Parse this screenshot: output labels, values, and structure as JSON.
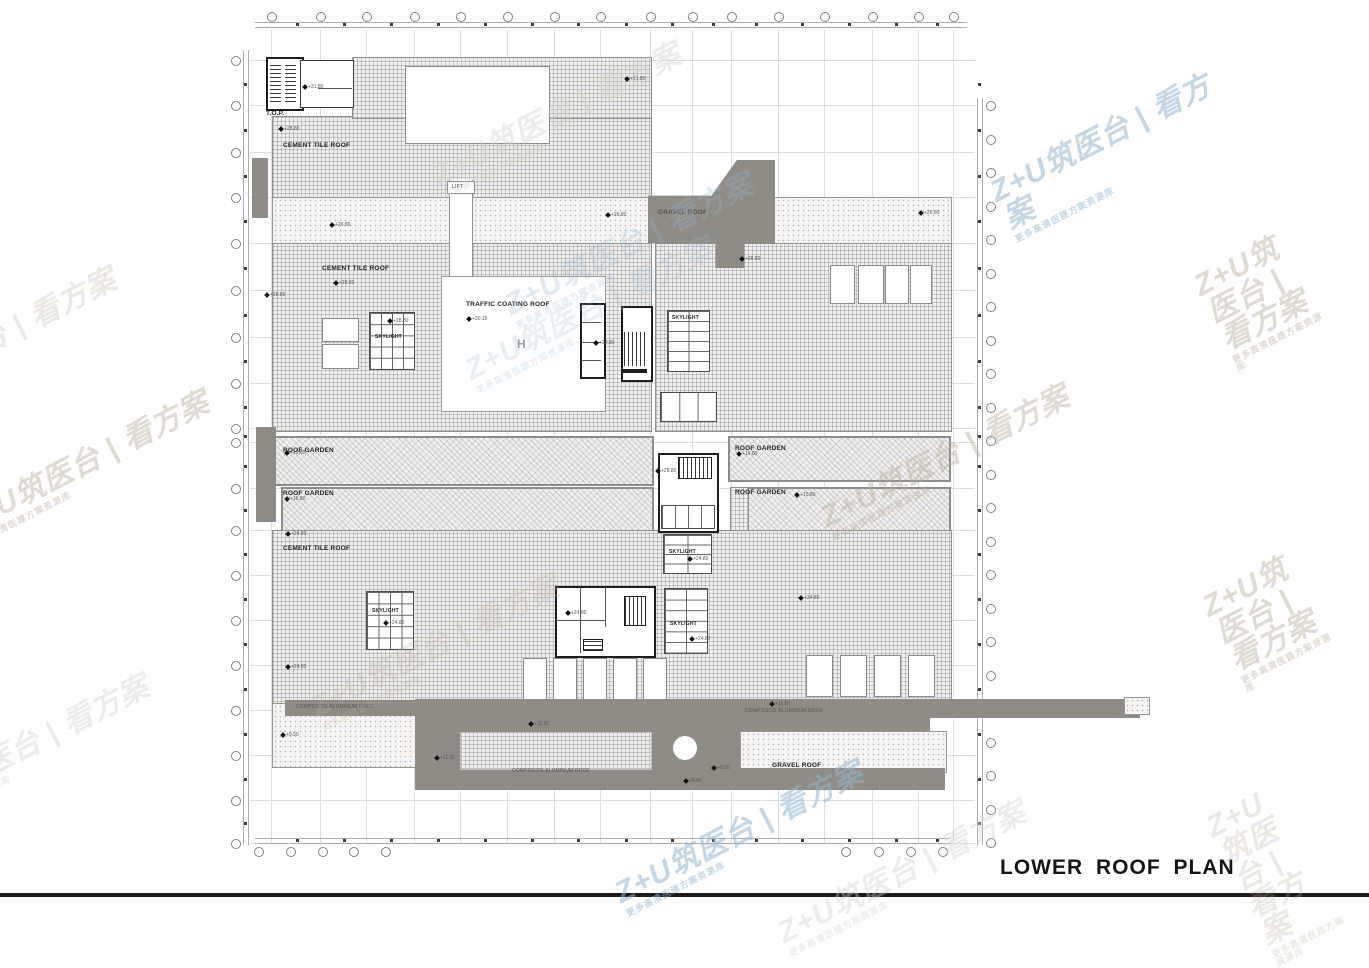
{
  "title": "LOWER ROOF PLAN",
  "watermark": {
    "main": "Z+U筑医台 | 看方案",
    "sub": "更多高清医建方案资源库"
  },
  "labels": {
    "top_of_parapet": "T.O.P.",
    "cement_tile_roof": "CEMENT TILE ROOF",
    "traffic_coating_roof": "TRAFFIC COATING ROOF",
    "skylight": "SKYLIGHT",
    "roof_garden": "ROOF GARDEN",
    "gravel_roof": "GRAVEL ROOF",
    "composite_aluminum_roof": "COMPOSITE ALUMINUM ROOF",
    "lift": "LIFT",
    "helipad_mark": "H"
  },
  "level_markers": [
    {
      "x": 303,
      "y": 84,
      "v": "+31.80"
    },
    {
      "x": 279,
      "y": 126,
      "v": "+28.80"
    },
    {
      "x": 625,
      "y": 76,
      "v": "+31.80"
    },
    {
      "x": 330,
      "y": 222,
      "v": "+26.80"
    },
    {
      "x": 606,
      "y": 212,
      "v": "+26.80"
    },
    {
      "x": 919,
      "y": 210,
      "v": "+26.80"
    },
    {
      "x": 265,
      "y": 292,
      "v": "+28.80"
    },
    {
      "x": 334,
      "y": 280,
      "v": "+28.80"
    },
    {
      "x": 467,
      "y": 316,
      "v": "+30.15"
    },
    {
      "x": 740,
      "y": 256,
      "v": "+28.80"
    },
    {
      "x": 388,
      "y": 318,
      "v": "+28.80"
    },
    {
      "x": 594,
      "y": 340,
      "v": "+28.80"
    },
    {
      "x": 656,
      "y": 468,
      "v": "+28.80"
    },
    {
      "x": 285,
      "y": 450,
      "v": "+19.80"
    },
    {
      "x": 285,
      "y": 496,
      "v": "+16.80"
    },
    {
      "x": 737,
      "y": 451,
      "v": "+19.80"
    },
    {
      "x": 795,
      "y": 492,
      "v": "+19.80"
    },
    {
      "x": 286,
      "y": 531,
      "v": "+24.80"
    },
    {
      "x": 286,
      "y": 664,
      "v": "+24.80"
    },
    {
      "x": 384,
      "y": 620,
      "v": "+24.80"
    },
    {
      "x": 688,
      "y": 556,
      "v": "+24.80"
    },
    {
      "x": 690,
      "y": 636,
      "v": "+24.80"
    },
    {
      "x": 799,
      "y": 595,
      "v": "+24.80"
    },
    {
      "x": 566,
      "y": 610,
      "v": "+24.80"
    },
    {
      "x": 529,
      "y": 721,
      "v": "+11.50"
    },
    {
      "x": 770,
      "y": 701,
      "v": "+11.50"
    },
    {
      "x": 712,
      "y": 765,
      "v": "+9.50"
    },
    {
      "x": 281,
      "y": 732,
      "v": "+9.50"
    },
    {
      "x": 435,
      "y": 755,
      "v": "+11.50"
    },
    {
      "x": 684,
      "y": 778,
      "v": "+9.50"
    }
  ]
}
